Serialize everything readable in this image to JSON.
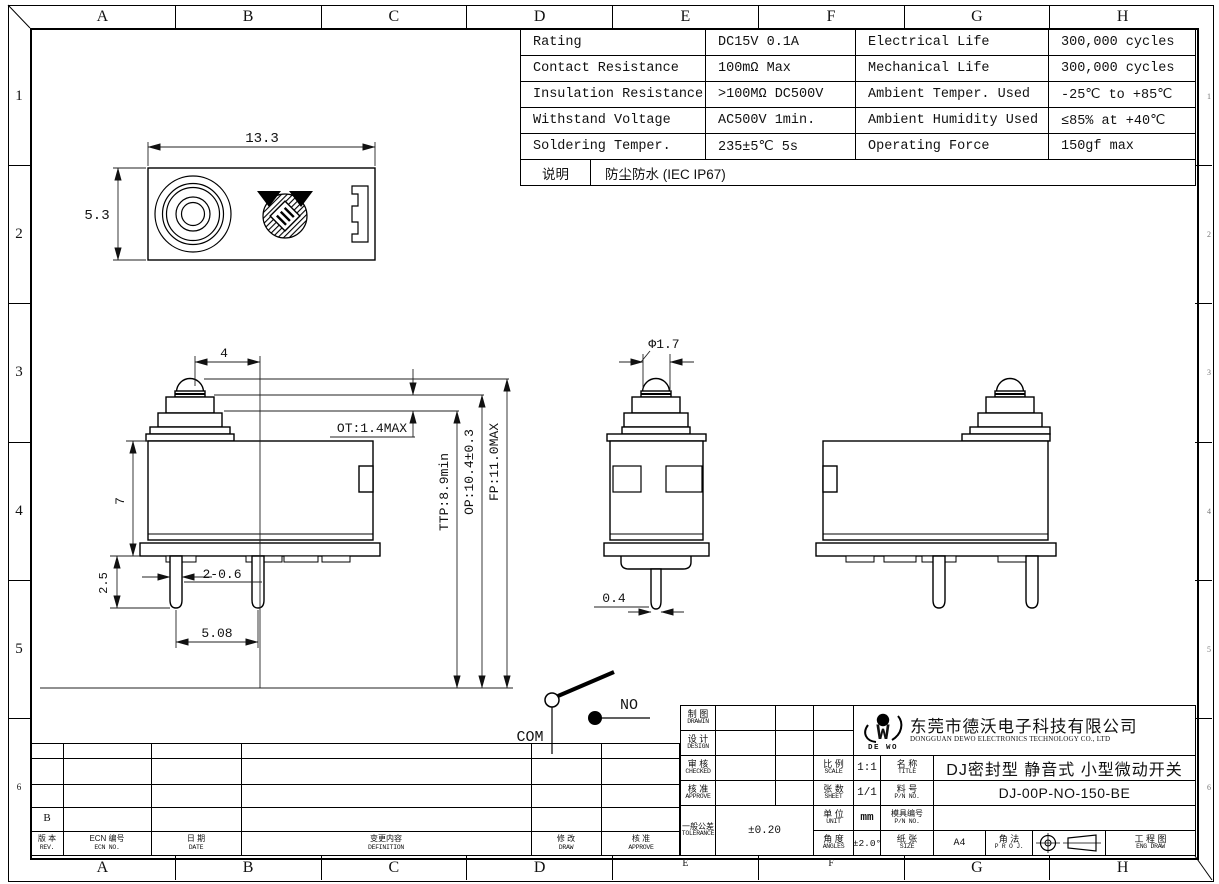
{
  "zones": {
    "columns": [
      "A",
      "B",
      "C",
      "D",
      "E",
      "F",
      "G",
      "H"
    ],
    "rows": [
      "1",
      "2",
      "3",
      "4",
      "5",
      "6"
    ]
  },
  "spec": {
    "rows": [
      {
        "c1": "Rating",
        "c2": "DC15V 0.1A",
        "c3": "Electrical Life",
        "c4": "300,000 cycles"
      },
      {
        "c1": "Contact Resistance",
        "c2": "100mΩ Max",
        "c3": "Mechanical Life",
        "c4": "300,000 cycles"
      },
      {
        "c1": "Insulation Resistance",
        "c2": ">100MΩ DC500V",
        "c3": "Ambient Temper. Used",
        "c4": "-25℃ to +85℃"
      },
      {
        "c1": "Withstand Voltage",
        "c2": "AC500V 1min.",
        "c3": "Ambient Humidity Used",
        "c4": "≤85% at +40℃"
      },
      {
        "c1": "Soldering Temper.",
        "c2": "235±5℃ 5s",
        "c3": "Operating Force",
        "c4": "150gf max"
      }
    ]
  },
  "note": {
    "label": "说明",
    "text": "防尘防水 (IEC IP67)"
  },
  "dims": {
    "top_width": "13.3",
    "top_height": "5.3",
    "plunger_offset": "4",
    "ot": "OT:1.4MAX",
    "ttp": "TTP:8.9min",
    "op": "OP:10.4±0.3",
    "fp": "FP:11.0MAX",
    "body_height": "7",
    "pin_length": "2.5",
    "pin_width": "2-0.6",
    "pin_pitch": "5.08",
    "plunger_dia": "Φ1.7",
    "pin_thickness": "0.4"
  },
  "circuit": {
    "com": "COM",
    "no": "NO"
  },
  "title_block": {
    "drawn": {
      "zh": "制 图",
      "en": "DRAWIN"
    },
    "design": {
      "zh": "设 计",
      "en": "DESIGN"
    },
    "checked": {
      "zh": "审 核",
      "en": "CHECKED"
    },
    "approved": {
      "zh": "核 准",
      "en": "APPROVE"
    },
    "tolerance": {
      "zh": "一般公差",
      "en": "TOLERANCE",
      "value": "±0.20"
    },
    "scale": {
      "zh": "比 例",
      "en": "SCALE",
      "value": "1:1"
    },
    "sheet": {
      "zh": "张 数",
      "en": "SHEET",
      "value": "1/1"
    },
    "unit": {
      "zh": "单 位",
      "en": "UNIT",
      "value": "mm"
    },
    "angles": {
      "zh": "角 度",
      "en": "ANGLES",
      "value": "±2.0°"
    },
    "title": {
      "zh": "名 称",
      "en": "TITLE",
      "value": "DJ密封型 静音式 小型微动开关"
    },
    "part_no": {
      "zh": "料 号",
      "en": "P/N NO.",
      "value": "DJ-00P-NO-150-BE"
    },
    "mold_no": {
      "zh": "模具编号",
      "en": "P/N NO.",
      "value": ""
    },
    "size": {
      "zh": "纸 张",
      "en": "SIZE",
      "value": "A4"
    },
    "projection": {
      "zh": "角 法",
      "en": "P R O J."
    },
    "eng_draw": {
      "zh": "工 程 图",
      "en": "ENG DRAW"
    },
    "company": {
      "zh": "东莞市德沃电子科技有限公司",
      "en": "DONGGUAN DEWO ELECTRONICS TECHNOLOGY CO., LTD",
      "logo": "DE WO",
      "logo_letter": "W"
    }
  },
  "revision": {
    "rev_value": "B",
    "headers": [
      {
        "zh": "版 本",
        "en": "REV."
      },
      {
        "zh": "ECN 编号",
        "en": "ECN NO."
      },
      {
        "zh": "日 期",
        "en": "DATE"
      },
      {
        "zh": "变更内容",
        "en": "DEFINITION"
      },
      {
        "zh": "修 改",
        "en": "DRAW"
      },
      {
        "zh": "核 准",
        "en": "APPROVE"
      }
    ]
  }
}
